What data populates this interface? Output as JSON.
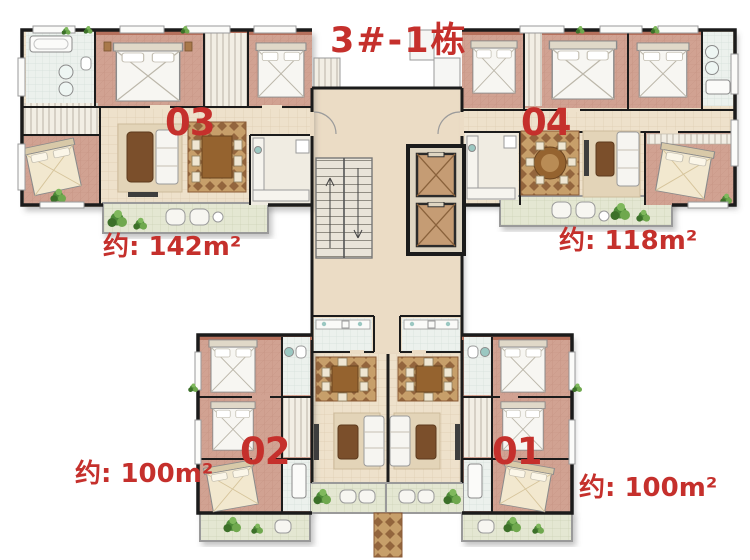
{
  "title": "3#-1栋",
  "units": [
    {
      "id": "03",
      "area_label": "约: 142m²",
      "position": "top-left"
    },
    {
      "id": "04",
      "area_label": "约: 118m²",
      "position": "top-right"
    },
    {
      "id": "02",
      "area_label": "约: 100m²",
      "position": "bottom-left"
    },
    {
      "id": "01",
      "area_label": "约: 100m²",
      "position": "bottom-right"
    }
  ],
  "core_features": {
    "elevators": 2,
    "staircase": 1
  },
  "colors": {
    "label_red": "#c5302c",
    "wall_black": "#1b1b1b",
    "floor_beige": "#eee1cb",
    "bedroom_pink": "#d1a292",
    "balcony_green_tile": "#e4e7d2",
    "bath_tile": "#ecf1ed",
    "carpet_brown": "#c79f6a",
    "furniture_brown": "#95632f",
    "plant_green": "#4d8a38"
  }
}
